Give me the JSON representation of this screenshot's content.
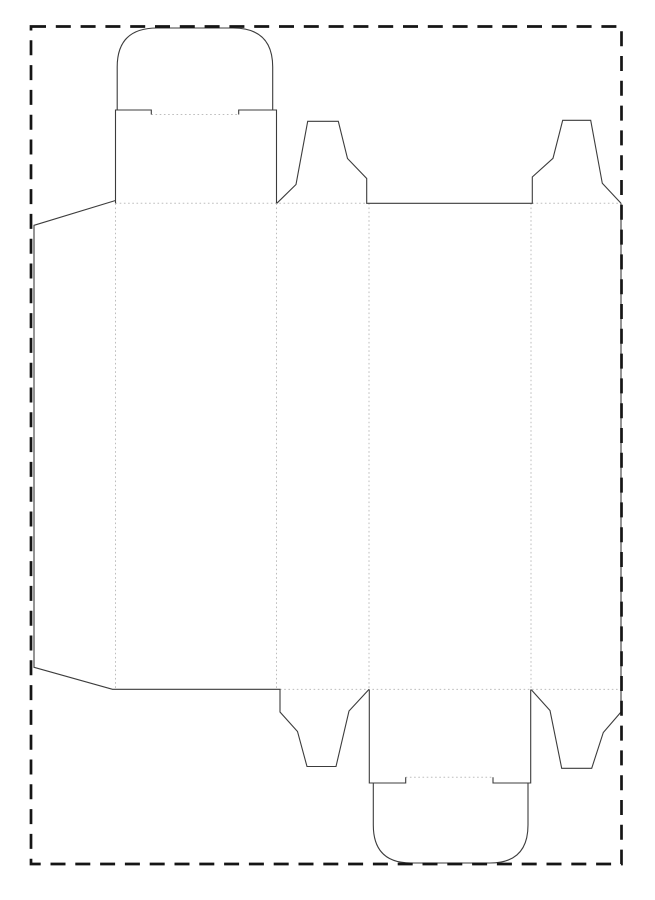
{
  "canvas": {
    "width": 655,
    "height": 900,
    "background": "#ffffff"
  },
  "colors": {
    "cut_line": "#3c3c3c",
    "fold_line": "#bdbdbd",
    "border": "#151515",
    "background": "#ffffff"
  },
  "border": {
    "name": "sheet-dashed-border",
    "x": 31,
    "y": 26.5,
    "width": 590.5,
    "height": 837.5,
    "stroke_width": 2.7,
    "dash": "15 9.8"
  },
  "dieline": {
    "cut_stroke_width": 1.1,
    "fold_stroke_width": 1,
    "fold_dash": "1.6 2.6",
    "cut_paths": [
      {
        "name": "top-panel-side-edges-and-tuck-slits",
        "d": "M 115.5 203.3 L 115.5 110 L 151.3 110 L 151.3 114.5 M 238.7 114.5 L 238.7 110 L 276.5 110 L 276.5 203.3"
      },
      {
        "name": "top-tuck-flap",
        "d": "M 117.2 110 L 117.2 67 Q 117.2 28 157 28 L 233 28 Q 272.7 28 272.7 67 L 272.7 110"
      },
      {
        "name": "glue-flap-panel1-bottom-edge-and-bottom-dust-flap-1",
        "d": "M 115.5 200.5 L 34 225.3 L 34 667.3 L 112.5 689.3 L 280 689.3 L 280 712 L 297.5 731.5 L 307 766.5 L 336 766.5 L 349 711 L 369 689.4"
      },
      {
        "name": "top-dust-flap-1-panel3-top-edge-and-top-dust-flap-2",
        "d": "M 276.8 203.3 L 296 184.5 L 307.7 121.3 L 338.3 121.3 L 347.5 158.5 L 366.7 178.5 L 366.7 203.3 L 532.3 203.3 L 532.3 177 L 553 158.3 L 562.7 120.3 L 590.7 120.3 L 602.3 183.3 L 621 203.3"
      },
      {
        "name": "panel4-right-cut-edge-and-bottom-dust-flap-2",
        "d": "M 621 203.3 L 621 712 L 603.3 732.5 L 591.7 768.3 L 561.7 768.3 L 550 710.5 L 531.2 689.6"
      },
      {
        "name": "bottom-panel-side-edges-and-tuck-slits",
        "d": "M 369.3 689.5 L 369.3 783 L 405.7 783 L 405.7 777.3 M 493 777.3 L 493 783 L 530.7 783 L 530.7 689.5"
      },
      {
        "name": "bottom-tuck-flap",
        "d": "M 373.3 783 L 373.3 825 Q 373.3 863 411 863 L 490 863 Q 528 863 528 825 L 528 783"
      }
    ],
    "fold_segments": [
      {
        "name": "fold-glue-flap-vertical",
        "x1": 115.5,
        "y1": 203.3,
        "x2": 115.5,
        "y2": 689.3
      },
      {
        "name": "fold-panel1-panel2-vertical",
        "x1": 276.5,
        "y1": 203.3,
        "x2": 276.5,
        "y2": 689.3
      },
      {
        "name": "fold-panel2-panel3-vertical",
        "x1": 369,
        "y1": 203.3,
        "x2": 369,
        "y2": 689.3
      },
      {
        "name": "fold-panel3-panel4-vertical",
        "x1": 531,
        "y1": 203.3,
        "x2": 531,
        "y2": 689.3
      },
      {
        "name": "fold-top-panel-and-dust-flap-1-base",
        "x1": 115.5,
        "y1": 203.3,
        "x2": 366.7,
        "y2": 203.3
      },
      {
        "name": "fold-top-dust-flap-2-base",
        "x1": 532.3,
        "y1": 203.3,
        "x2": 621,
        "y2": 203.3
      },
      {
        "name": "fold-bottom-horizontal",
        "x1": 280,
        "y1": 689.4,
        "x2": 621,
        "y2": 689.4
      },
      {
        "name": "fold-top-tuck-crease",
        "x1": 151.3,
        "y1": 114.5,
        "x2": 238.7,
        "y2": 114.5
      },
      {
        "name": "fold-bottom-tuck-crease",
        "x1": 405.7,
        "y1": 777.3,
        "x2": 493,
        "y2": 777.3
      }
    ]
  }
}
